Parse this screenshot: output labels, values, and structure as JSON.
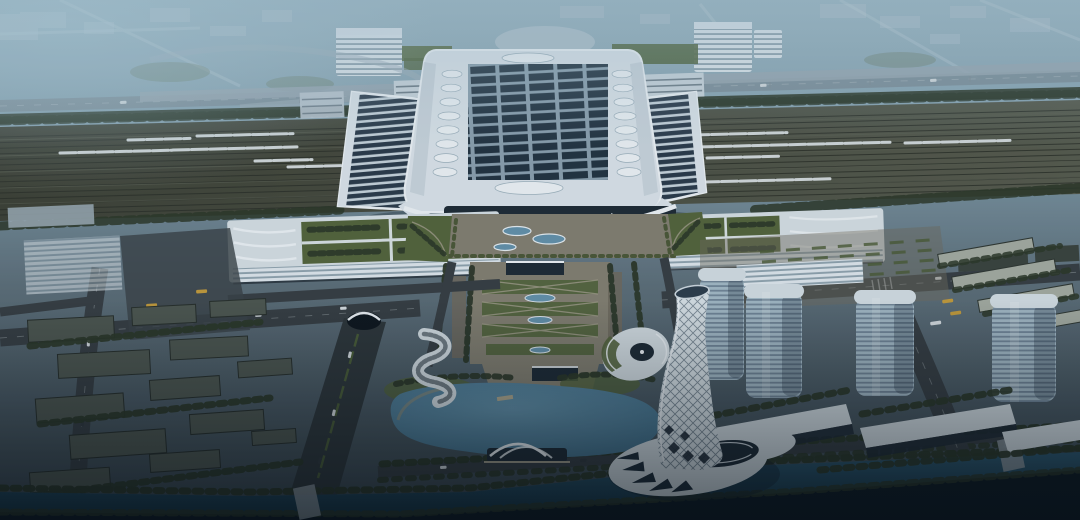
{
  "scene": {
    "title": "High-speed railway station complex — aerial dusk rendering",
    "description": "Bird's-eye architectural visualization at dusk: a vast rail yard with white high-speed trains crosses the top; the station's main hall carries a grid of dark solar panels flanked by striped platform-wing canopies; twin annex buildings with rooftop gardens frame a landscaped central axis with oval ponds that leads to a lake; a white spiral lattice tower flares into a podium by the water; glass office towers with long podium slabs stand to the southeast; dark low-rise city blocks fill the southwest; a tree-lined canal runs along the bottom edge.",
    "setting": "aerial view, dusk, blue haze toward the horizon",
    "landmarks": [
      "rail yard with high-speed trains",
      "station main hall with solar-panel roof and teardrop vents",
      "striped west and east wing canopies",
      "annex buildings with rooftop garden courtyards",
      "landscaped central axis with oval ponds",
      "forecourt plaza with oval skylights",
      "lake with arched lakeside pavilion",
      "S-curve building",
      "fan terrace building",
      "spiral lattice tower with flared podium",
      "four glass office towers with podium slabs",
      "east residential rows",
      "west district low-rise blocks",
      "tree-lined canal and south bank",
      "elevated approach viaduct",
      "hazy distant cityscape"
    ]
  },
  "colors": {
    "skyTop": "#98b3bf",
    "hazeBlock": "#b4c4cd",
    "domeHaze": "#b8c7d0",
    "roadFar": "#7b8c96",
    "treeDark": "#2b3626",
    "treeMid": "#45532f",
    "grass": "#53633a",
    "trackLine": "#2c2f27",
    "trackLineLight": "#585c4e",
    "trainWhite": "#d3d9da",
    "roofWhite": "#dce4ea",
    "roofBright": "#eef3f6",
    "roofShade": "#b7c4cd",
    "panelDark": "#22323f",
    "panelFrame": "#8ba0ae",
    "wingDark": "#2b3a49",
    "wingRib": "#c6d2da",
    "glassLight": "#a3b8c4",
    "glassDark": "#64788a",
    "towerCap": "#d3dde2",
    "whiteBldg": "#d7dfe4",
    "facadeGlass": "#1e2933",
    "winLight": "#dfe7ec",
    "winDark": "#8fa2ad",
    "road": "#363d41",
    "roadDark": "#2e3539",
    "laneMark": "#cfd6da",
    "greenMedian": "#4e6135",
    "plazaTan": "#837e6f",
    "pathLight": "#a29c8a",
    "lakeLight": "#6391a9",
    "lakeDeep": "#3e6c87",
    "canalLight": "#2e586f",
    "canalDeep": "#12303f",
    "slabTop": "#4d554e",
    "slabDark": "#394039",
    "eastSlab": "#a4aaa0",
    "busYellow": "#c39a3a",
    "carWhite": "#d8dde0",
    "carDark": "#31383d"
  }
}
